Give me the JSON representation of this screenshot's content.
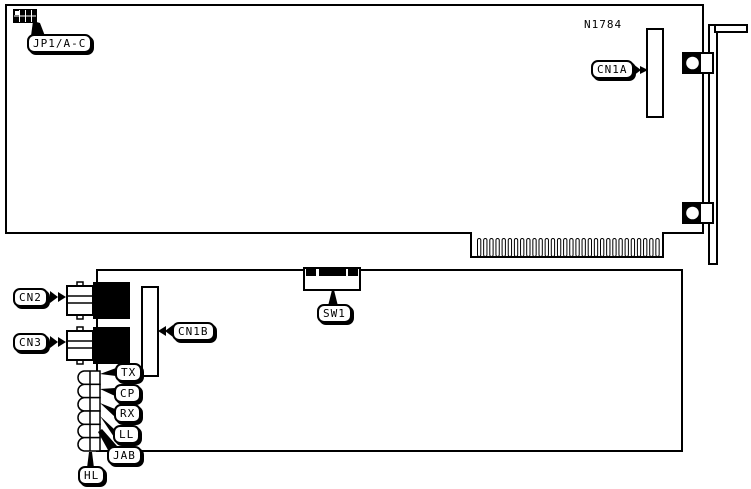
{
  "diagram": {
    "colors": {
      "ink": "#000000",
      "paper": "#ffffff"
    },
    "part_number": "N1784",
    "labels": {
      "jp1": "JP1/A-C",
      "cn1a": "CN1A",
      "cn2": "CN2",
      "cn3": "CN3",
      "cn1b": "CN1B",
      "sw1": "SW1",
      "tx": "TX",
      "cp": "CP",
      "rx": "RX",
      "ll": "LL",
      "jab": "JAB",
      "hl": "HL"
    },
    "card_edge": {
      "finger_count": 30
    },
    "leds": {
      "count": 6
    },
    "dip_switch": {
      "segments": [
        {
          "x": 306,
          "w": 10
        },
        {
          "x": 319,
          "w": 27
        },
        {
          "x": 348,
          "w": 10
        }
      ]
    }
  }
}
